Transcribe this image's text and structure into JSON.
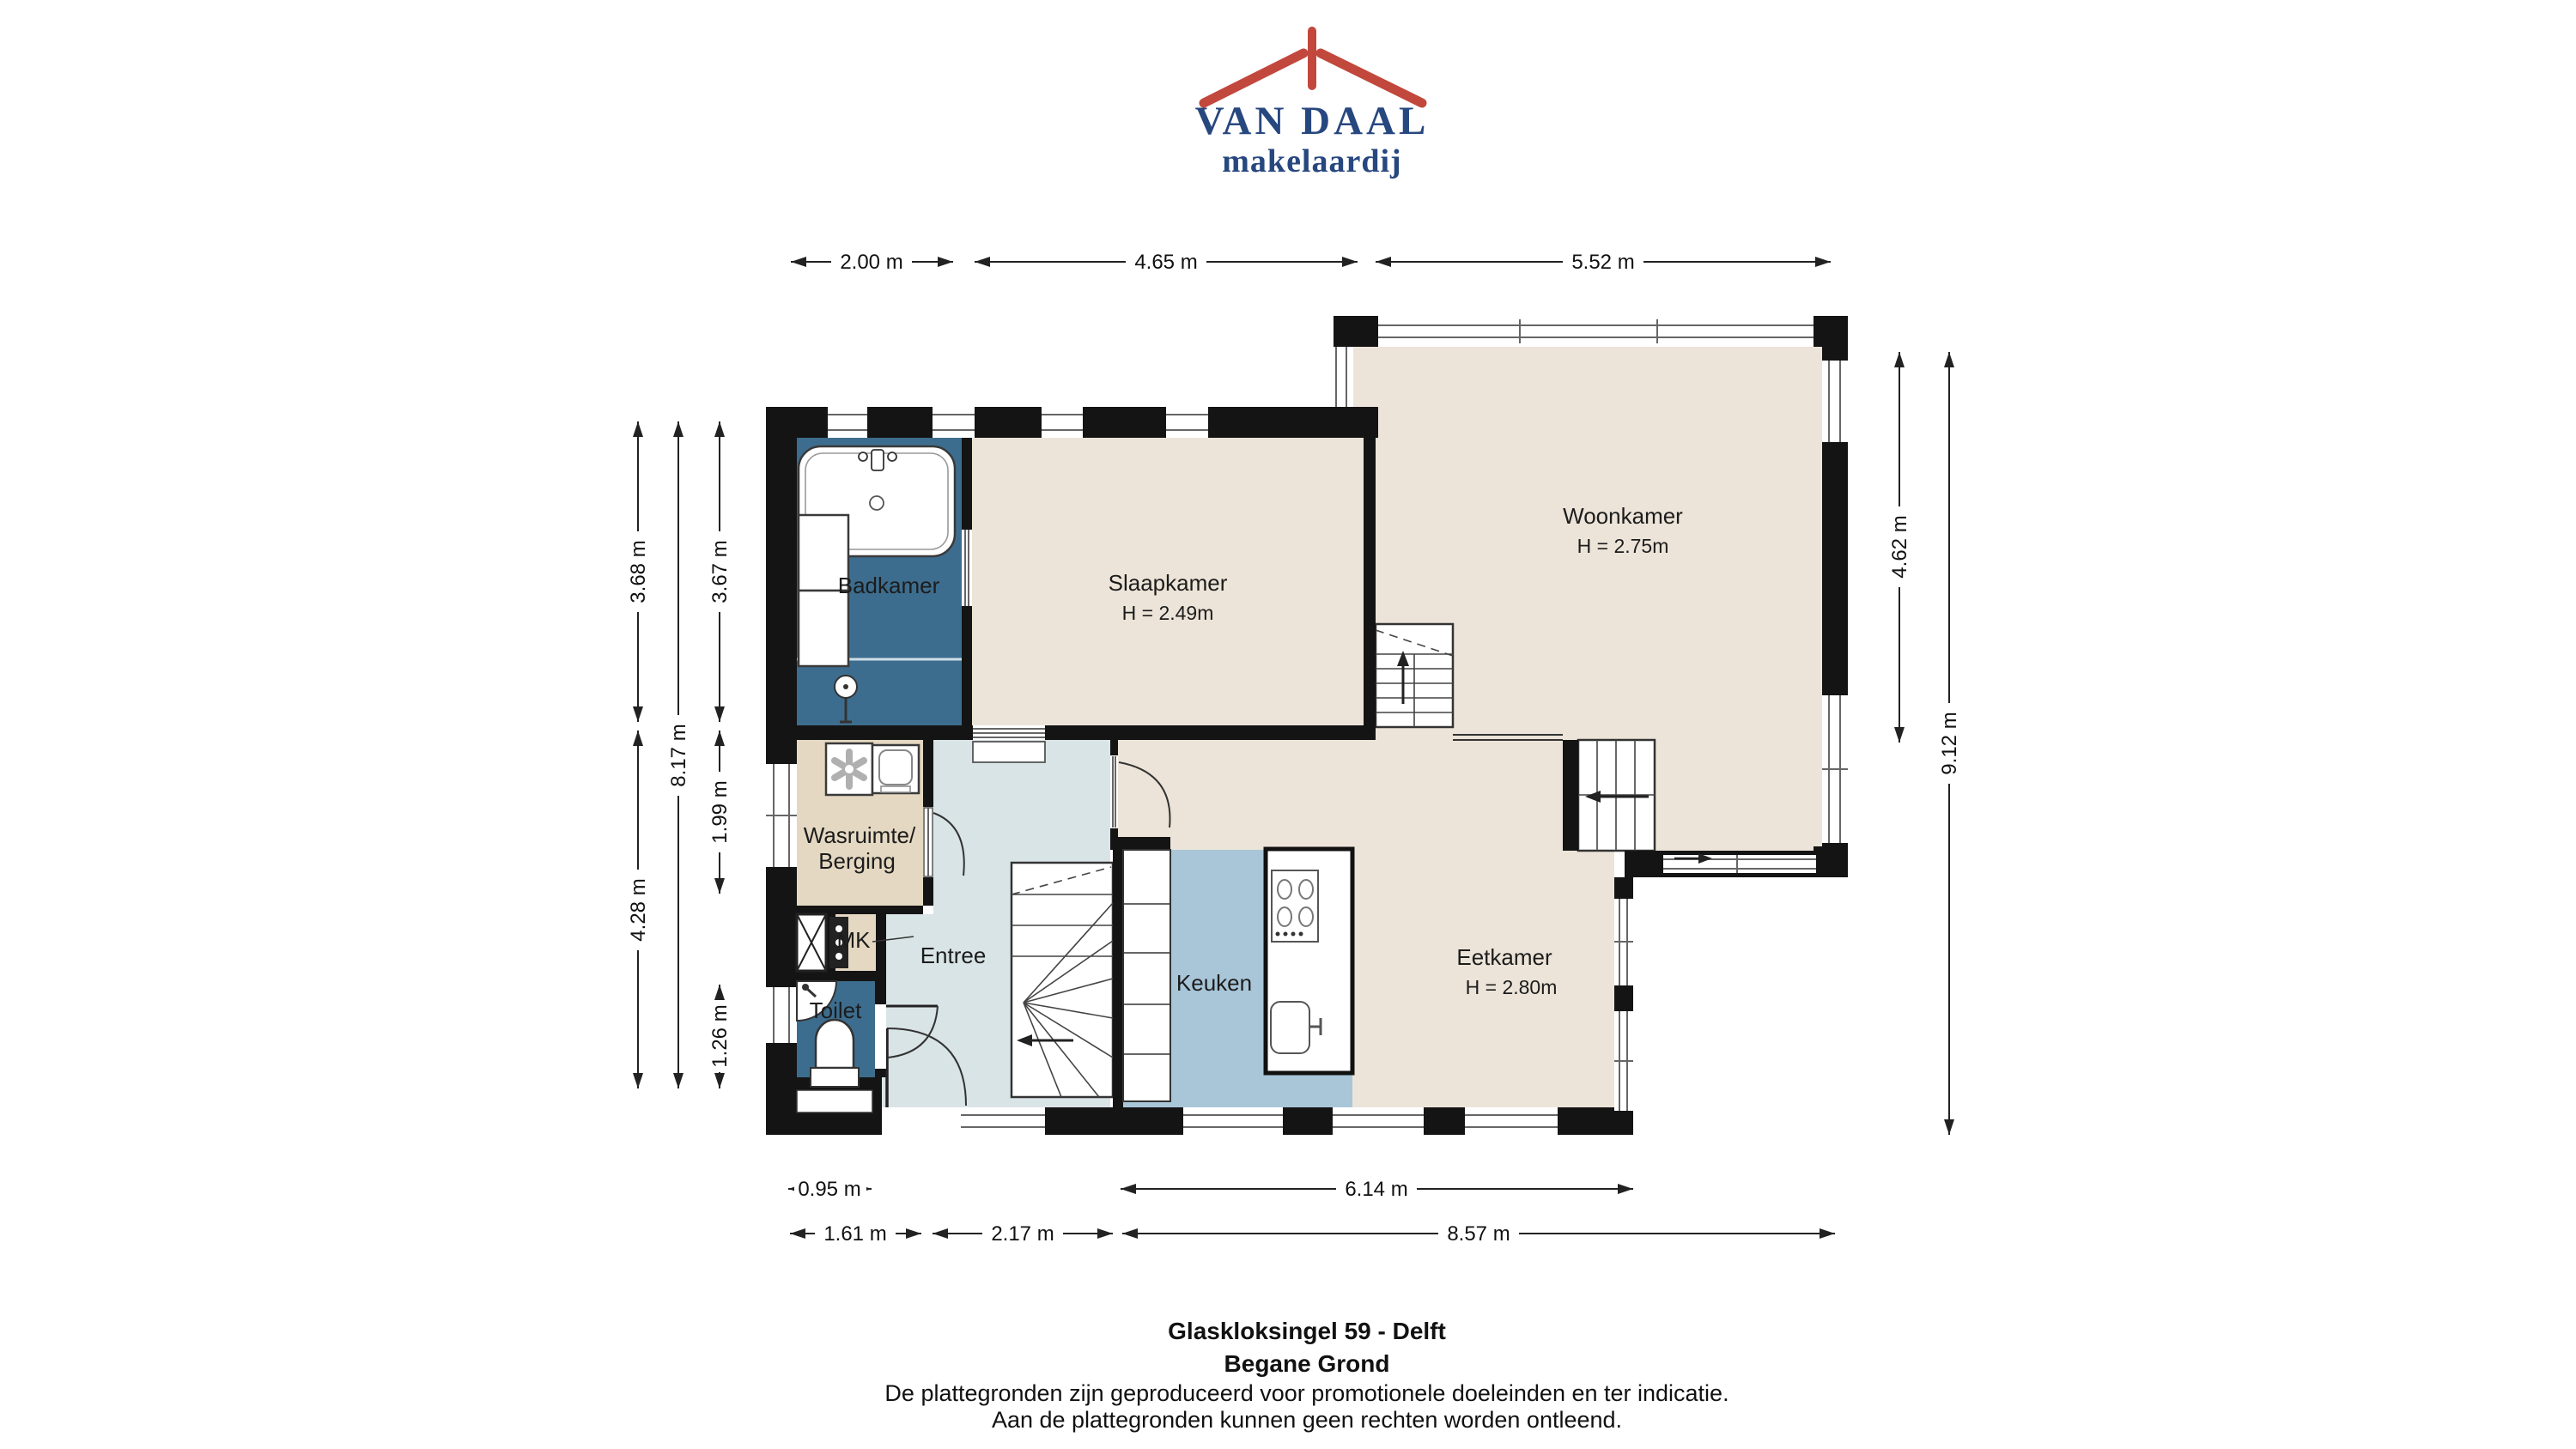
{
  "logo": {
    "name1": "VAN DAAL",
    "name2": "makelaardij"
  },
  "colors": {
    "wall": "#141414",
    "beige": "#ece4d8",
    "tan": "#e4d8c2",
    "bathroom_blue": "#3d6d8e",
    "kitchen_blue": "#a9c6d9",
    "entry_grey": "#d9e4e6",
    "logo_navy": "#27477f",
    "logo_red": "#c2473d"
  },
  "rooms": [
    {
      "key": "badkamer",
      "label": "Badkamer"
    },
    {
      "key": "slaapkamer",
      "label": "Slaapkamer",
      "height": "H = 2.49m"
    },
    {
      "key": "woonkamer",
      "label": "Woonkamer",
      "height": "H = 2.75m"
    },
    {
      "key": "wasruimte",
      "label": "Wasruimte/",
      "label2": "Berging"
    },
    {
      "key": "mk",
      "label": "MK"
    },
    {
      "key": "entree",
      "label": "Entree"
    },
    {
      "key": "toilet",
      "label": "Toilet"
    },
    {
      "key": "keuken",
      "label": "Keuken"
    },
    {
      "key": "eetkamer",
      "label": "Eetkamer",
      "height": "H = 2.80m"
    }
  ],
  "dimensions": {
    "top": [
      "2.00 m",
      "4.65 m",
      "5.52 m"
    ],
    "bottom_inner": [
      "0.95 m",
      "6.14 m"
    ],
    "bottom_outer": [
      "1.61 m",
      "2.17 m",
      "8.57 m"
    ],
    "left_outer": [
      "3.68 m",
      "4.28 m"
    ],
    "left_middle": [
      "8.17 m"
    ],
    "left_inner": [
      "3.67 m",
      "1.99 m",
      "1.26 m"
    ],
    "right_inner": [
      "4.62 m"
    ],
    "right_outer": [
      "9.12 m"
    ]
  },
  "footer": {
    "address": "Glaskloksingel 59 - Delft",
    "floor": "Begane Grond",
    "disclaimer1": "De plattegronden zijn geproduceerd voor promotionele doeleinden en ter indicatie.",
    "disclaimer2": "Aan de plattegronden kunnen geen rechten worden ontleend."
  }
}
